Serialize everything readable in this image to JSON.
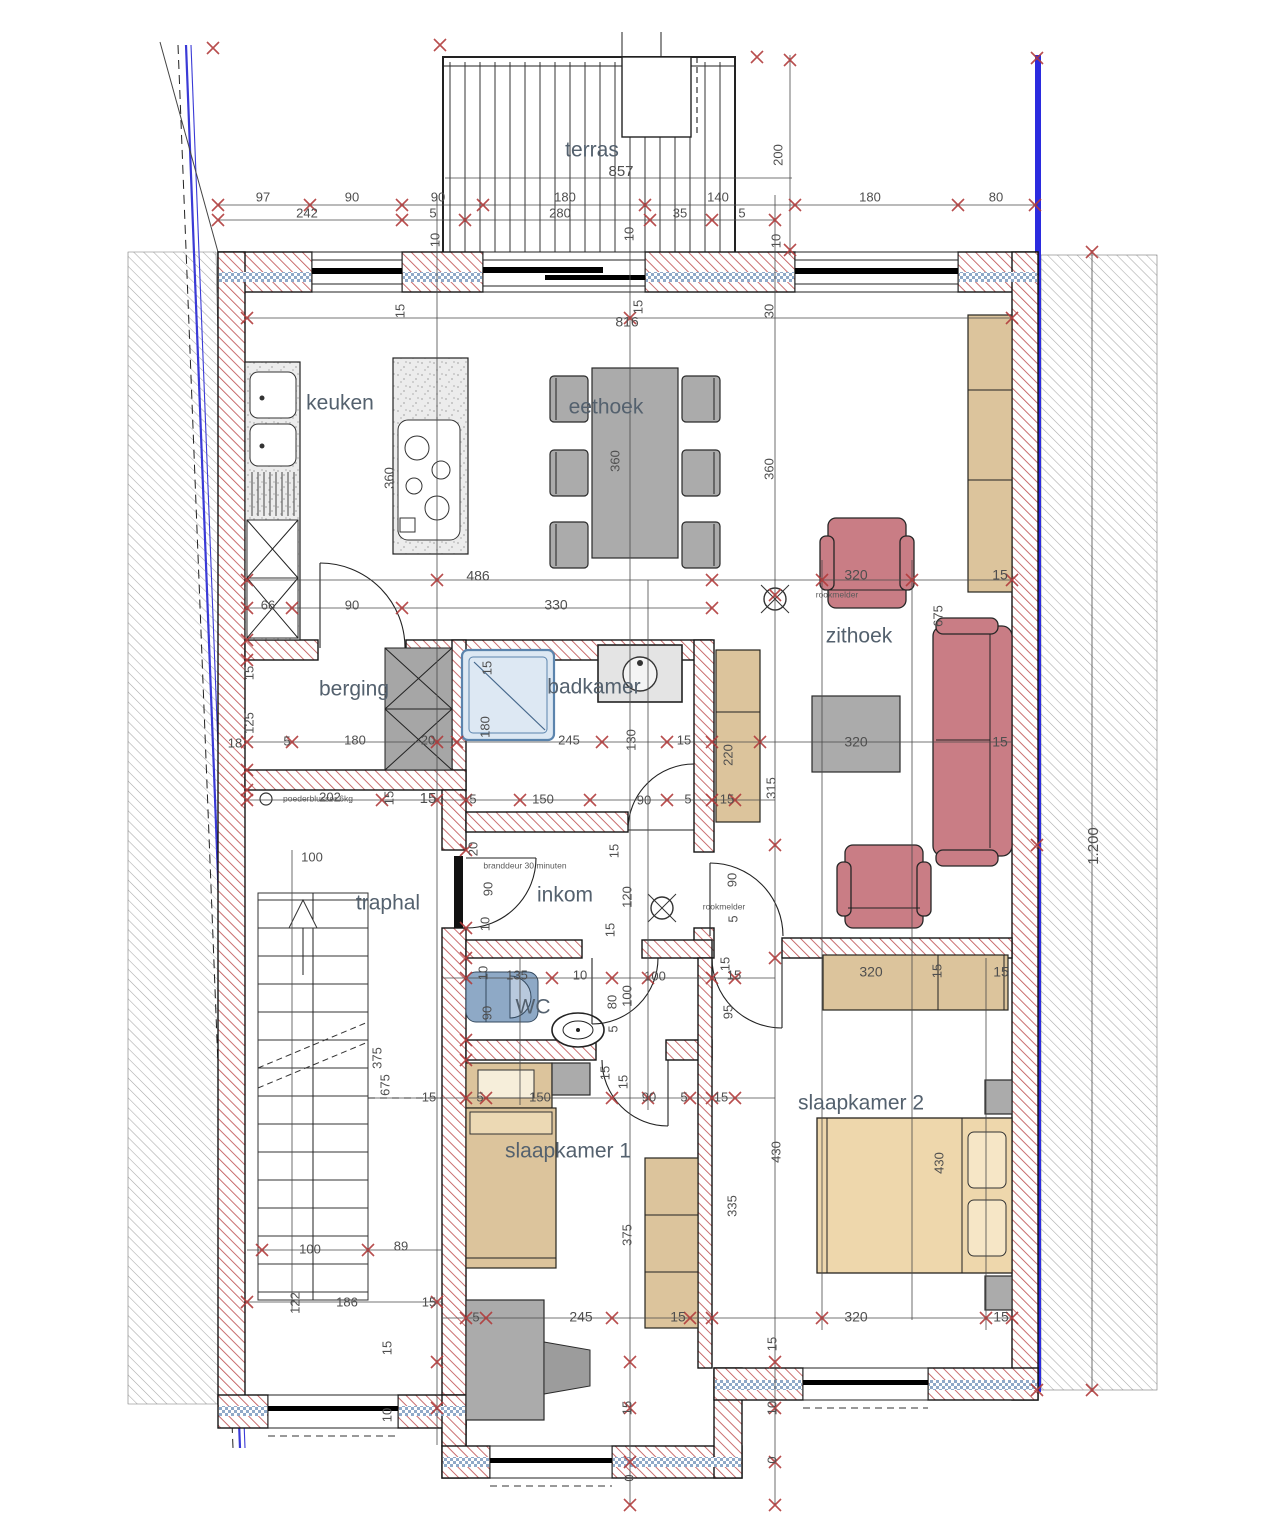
{
  "plan": {
    "palette": {
      "wall_hatch_red": "#c05556",
      "boundary_blue": "#2b2bdf",
      "furniture_red": "#c97d85",
      "furniture_tan": "#dcc49c",
      "furniture_gray": "#ababab",
      "insulation_blue": "#8fa9c8"
    },
    "rooms": [
      {
        "t": "terras",
        "x": 592,
        "y": 151
      },
      {
        "t": "keuken",
        "x": 340,
        "y": 404
      },
      {
        "t": "eethoek",
        "x": 606,
        "y": 408
      },
      {
        "t": "zithoek",
        "x": 859,
        "y": 637
      },
      {
        "t": "berging",
        "x": 354,
        "y": 690
      },
      {
        "t": "badkamer",
        "x": 594,
        "y": 688
      },
      {
        "t": "traphal",
        "x": 388,
        "y": 904
      },
      {
        "t": "inkom",
        "x": 565,
        "y": 896
      },
      {
        "t": "WC",
        "x": 533,
        "y": 1008
      },
      {
        "t": "slaapkamer 1",
        "x": 568,
        "y": 1152
      },
      {
        "t": "slaapkamer 2",
        "x": 861,
        "y": 1104
      }
    ],
    "annotations": [
      {
        "t": "rookmelder",
        "x": 837,
        "y": 595
      },
      {
        "t": "rookmelder",
        "x": 724,
        "y": 907
      },
      {
        "t": "poederblusser 6kg",
        "x": 318,
        "y": 799
      },
      {
        "t": "branddeur 30 minuten",
        "x": 525,
        "y": 866
      }
    ],
    "dim_labels": [
      {
        "t": "97",
        "x": 263,
        "y": 198
      },
      {
        "t": "90",
        "x": 352,
        "y": 198
      },
      {
        "t": "90",
        "x": 438,
        "y": 198
      },
      {
        "t": "180",
        "x": 565,
        "y": 198
      },
      {
        "t": "140",
        "x": 718,
        "y": 198
      },
      {
        "t": "180",
        "x": 870,
        "y": 198
      },
      {
        "t": "80",
        "x": 996,
        "y": 198
      },
      {
        "t": "242",
        "x": 307,
        "y": 214
      },
      {
        "t": "5",
        "x": 433,
        "y": 214
      },
      {
        "t": "280",
        "x": 560,
        "y": 214
      },
      {
        "t": "35",
        "x": 680,
        "y": 214
      },
      {
        "t": "5",
        "x": 742,
        "y": 214
      },
      {
        "t": "857",
        "x": 621,
        "y": 172,
        "s": 15
      },
      {
        "t": "200",
        "x": 779,
        "y": 155,
        "r": 1
      },
      {
        "t": "10",
        "x": 436,
        "y": 240,
        "r": 1
      },
      {
        "t": "10",
        "x": 630,
        "y": 234,
        "r": 1
      },
      {
        "t": "10",
        "x": 777,
        "y": 241,
        "r": 1
      },
      {
        "t": "15",
        "x": 401,
        "y": 311,
        "r": 1
      },
      {
        "t": "816",
        "x": 627,
        "y": 323,
        "s": 14
      },
      {
        "t": "15",
        "x": 639,
        "y": 307,
        "r": 1
      },
      {
        "t": "30",
        "x": 770,
        "y": 311,
        "r": 1
      },
      {
        "t": "360",
        "x": 390,
        "y": 478,
        "r": 1
      },
      {
        "t": "360",
        "x": 616,
        "y": 461,
        "r": 1
      },
      {
        "t": "360",
        "x": 770,
        "y": 469,
        "r": 1
      },
      {
        "t": "486",
        "x": 478,
        "y": 577,
        "s": 14
      },
      {
        "t": "320",
        "x": 856,
        "y": 576,
        "s": 14
      },
      {
        "t": "15",
        "x": 1000,
        "y": 576,
        "s": 14
      },
      {
        "t": "66",
        "x": 268,
        "y": 606
      },
      {
        "t": "90",
        "x": 352,
        "y": 606
      },
      {
        "t": "330",
        "x": 556,
        "y": 606,
        "s": 14
      },
      {
        "t": "675",
        "x": 939,
        "y": 616,
        "r": 1
      },
      {
        "t": "320",
        "x": 856,
        "y": 743,
        "s": 14
      },
      {
        "t": "15",
        "x": 1000,
        "y": 743,
        "s": 14
      },
      {
        "t": "315",
        "x": 772,
        "y": 788,
        "r": 1
      },
      {
        "t": "15",
        "x": 250,
        "y": 673,
        "r": 1
      },
      {
        "t": "125",
        "x": 250,
        "y": 723,
        "r": 1
      },
      {
        "t": "18",
        "x": 235,
        "y": 744
      },
      {
        "t": "5",
        "x": 287,
        "y": 742
      },
      {
        "t": "180",
        "x": 355,
        "y": 741
      },
      {
        "t": "20",
        "x": 428,
        "y": 741
      },
      {
        "t": "15",
        "x": 488,
        "y": 668,
        "r": 1
      },
      {
        "t": "180",
        "x": 486,
        "y": 727,
        "r": 1
      },
      {
        "t": "245",
        "x": 569,
        "y": 741
      },
      {
        "t": "130",
        "x": 632,
        "y": 740,
        "r": 1
      },
      {
        "t": "15",
        "x": 684,
        "y": 741
      },
      {
        "t": "220",
        "x": 729,
        "y": 755,
        "r": 1
      },
      {
        "t": "202",
        "x": 330,
        "y": 798
      },
      {
        "t": "15",
        "x": 390,
        "y": 798,
        "r": 1
      },
      {
        "t": "15",
        "x": 428,
        "y": 799,
        "s": 15
      },
      {
        "t": "5",
        "x": 473,
        "y": 800
      },
      {
        "t": "150",
        "x": 543,
        "y": 800
      },
      {
        "t": "90",
        "x": 644,
        "y": 801
      },
      {
        "t": "5",
        "x": 688,
        "y": 800
      },
      {
        "t": "15",
        "x": 727,
        "y": 800
      },
      {
        "t": "100",
        "x": 312,
        "y": 858
      },
      {
        "t": "20",
        "x": 474,
        "y": 849,
        "r": 1
      },
      {
        "t": "90",
        "x": 489,
        "y": 889,
        "r": 1
      },
      {
        "t": "10",
        "x": 486,
        "y": 924,
        "r": 1
      },
      {
        "t": "15",
        "x": 615,
        "y": 851,
        "r": 1
      },
      {
        "t": "120",
        "x": 628,
        "y": 897,
        "r": 1
      },
      {
        "t": "15",
        "x": 611,
        "y": 930,
        "r": 1
      },
      {
        "t": "90",
        "x": 733,
        "y": 880,
        "r": 1
      },
      {
        "t": "5",
        "x": 734,
        "y": 919,
        "r": 1
      },
      {
        "t": "10",
        "x": 484,
        "y": 973,
        "r": 1
      },
      {
        "t": "135",
        "x": 517,
        "y": 976
      },
      {
        "t": "10",
        "x": 580,
        "y": 976
      },
      {
        "t": "100",
        "x": 655,
        "y": 977
      },
      {
        "t": "15",
        "x": 734,
        "y": 976
      },
      {
        "t": "90",
        "x": 488,
        "y": 1013,
        "r": 1
      },
      {
        "t": "80",
        "x": 613,
        "y": 1002,
        "r": 1
      },
      {
        "t": "100",
        "x": 628,
        "y": 996,
        "r": 1
      },
      {
        "t": "5",
        "x": 614,
        "y": 1029,
        "r": 1
      },
      {
        "t": "15",
        "x": 726,
        "y": 964,
        "r": 1
      },
      {
        "t": "95",
        "x": 729,
        "y": 1012,
        "r": 1
      },
      {
        "t": "15",
        "x": 606,
        "y": 1073,
        "r": 1
      },
      {
        "t": "15",
        "x": 624,
        "y": 1082,
        "r": 1
      },
      {
        "t": "5",
        "x": 480,
        "y": 1098
      },
      {
        "t": "150",
        "x": 540,
        "y": 1098
      },
      {
        "t": "90",
        "x": 649,
        "y": 1098
      },
      {
        "t": "5",
        "x": 684,
        "y": 1098
      },
      {
        "t": "15",
        "x": 721,
        "y": 1098
      },
      {
        "t": "375",
        "x": 378,
        "y": 1058,
        "r": 1
      },
      {
        "t": "675",
        "x": 386,
        "y": 1085,
        "r": 1
      },
      {
        "t": "15",
        "x": 429,
        "y": 1098
      },
      {
        "t": "100",
        "x": 310,
        "y": 1250
      },
      {
        "t": "89",
        "x": 401,
        "y": 1247
      },
      {
        "t": "122",
        "x": 296,
        "y": 1303,
        "r": 1
      },
      {
        "t": "186",
        "x": 347,
        "y": 1303
      },
      {
        "t": "15",
        "x": 429,
        "y": 1303
      },
      {
        "t": "320",
        "x": 871,
        "y": 973,
        "s": 14
      },
      {
        "t": "15",
        "x": 938,
        "y": 971,
        "r": 1
      },
      {
        "t": "15",
        "x": 1001,
        "y": 973,
        "s": 14
      },
      {
        "t": "430",
        "x": 777,
        "y": 1152,
        "r": 1
      },
      {
        "t": "430",
        "x": 940,
        "y": 1163,
        "r": 1
      },
      {
        "t": "375",
        "x": 628,
        "y": 1235,
        "r": 1
      },
      {
        "t": "335",
        "x": 733,
        "y": 1206,
        "r": 1
      },
      {
        "t": "5",
        "x": 476,
        "y": 1318
      },
      {
        "t": "245",
        "x": 581,
        "y": 1318,
        "s": 14
      },
      {
        "t": "15",
        "x": 678,
        "y": 1318,
        "s": 14
      },
      {
        "t": "320",
        "x": 856,
        "y": 1318,
        "s": 14
      },
      {
        "t": "15",
        "x": 1001,
        "y": 1318,
        "s": 14
      },
      {
        "t": "15",
        "x": 388,
        "y": 1348,
        "r": 1
      },
      {
        "t": "10",
        "x": 388,
        "y": 1415,
        "r": 1
      },
      {
        "t": "15",
        "x": 628,
        "y": 1408,
        "r": 1
      },
      {
        "t": "0",
        "x": 630,
        "y": 1478,
        "r": 1
      },
      {
        "t": "15",
        "x": 773,
        "y": 1344,
        "r": 1
      },
      {
        "t": "10",
        "x": 773,
        "y": 1408,
        "r": 1
      },
      {
        "t": "0",
        "x": 773,
        "y": 1460,
        "r": 1
      },
      {
        "t": "1.200",
        "x": 1094,
        "y": 846,
        "r": 1,
        "s": 15
      }
    ]
  }
}
